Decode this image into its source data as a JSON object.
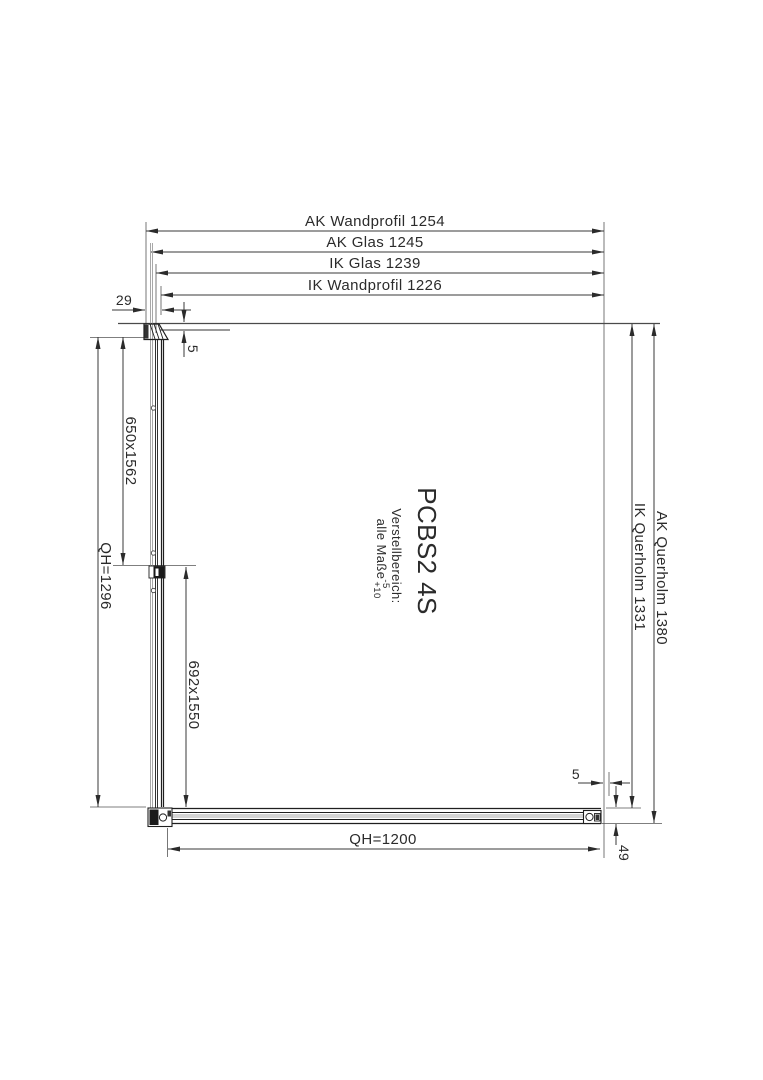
{
  "drawing": {
    "model": "PCBS2 4S",
    "note": {
      "line1": "Verstellbereich:",
      "line2": "alle Maße",
      "tol_upper": "-5",
      "tol_lower": "+10"
    },
    "dims": {
      "ak_wandprofil": "AK Wandprofil 1254",
      "ak_glas": "AK Glas 1245",
      "ik_glas": "IK Glas 1239",
      "ik_wandprofil": "IK Wandprofil 1226",
      "wall_offset": "29",
      "gap_top": "5",
      "glass_left": "650x1562",
      "qh_left": "QH=1296",
      "glass_right": "692x1550",
      "ak_querholm": "AK Querholm 1380",
      "ik_querholm": "IK Querholm 1331",
      "gap_bottom": "5",
      "qh_bottom": "QH=1200",
      "querholm_height": "49"
    },
    "colors": {
      "line": "#2b2b2b",
      "glass": "#a8a8a8",
      "background": "#ffffff"
    }
  }
}
